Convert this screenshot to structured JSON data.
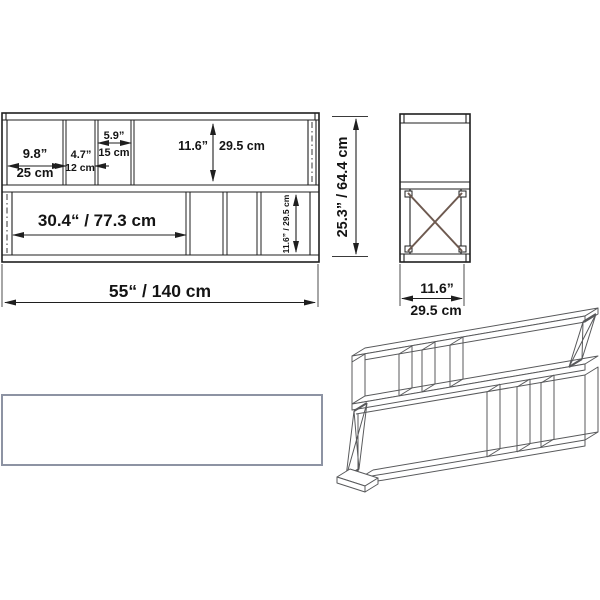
{
  "drawing_title": "shelf-unit-dimension-drawing",
  "colors": {
    "main_line": "#1f1f1f",
    "perspective_line": "#58595b",
    "top_view_border": "#8d93a3",
    "x_brace_diagonal": "#6e5a50",
    "text": "#141414"
  },
  "front_view": {
    "c1_in": "9.8”",
    "c1_cm": "25 cm",
    "c2_in": "4.7”",
    "c2_cm": "12 cm",
    "c3_in": "5.9”",
    "c3_cm": "15 cm",
    "h_upper_in": "11.6”",
    "h_upper_cm": "29.5 cm",
    "span_lower": "30.4“ / 77.3 cm",
    "h_lower": "11.6” / 29.5 cm",
    "total_width": "55“ / 140 cm"
  },
  "side_view": {
    "total_height": "25.3” / 64.4 cm",
    "depth_in": "11.6”",
    "depth_cm": "29.5 cm"
  }
}
